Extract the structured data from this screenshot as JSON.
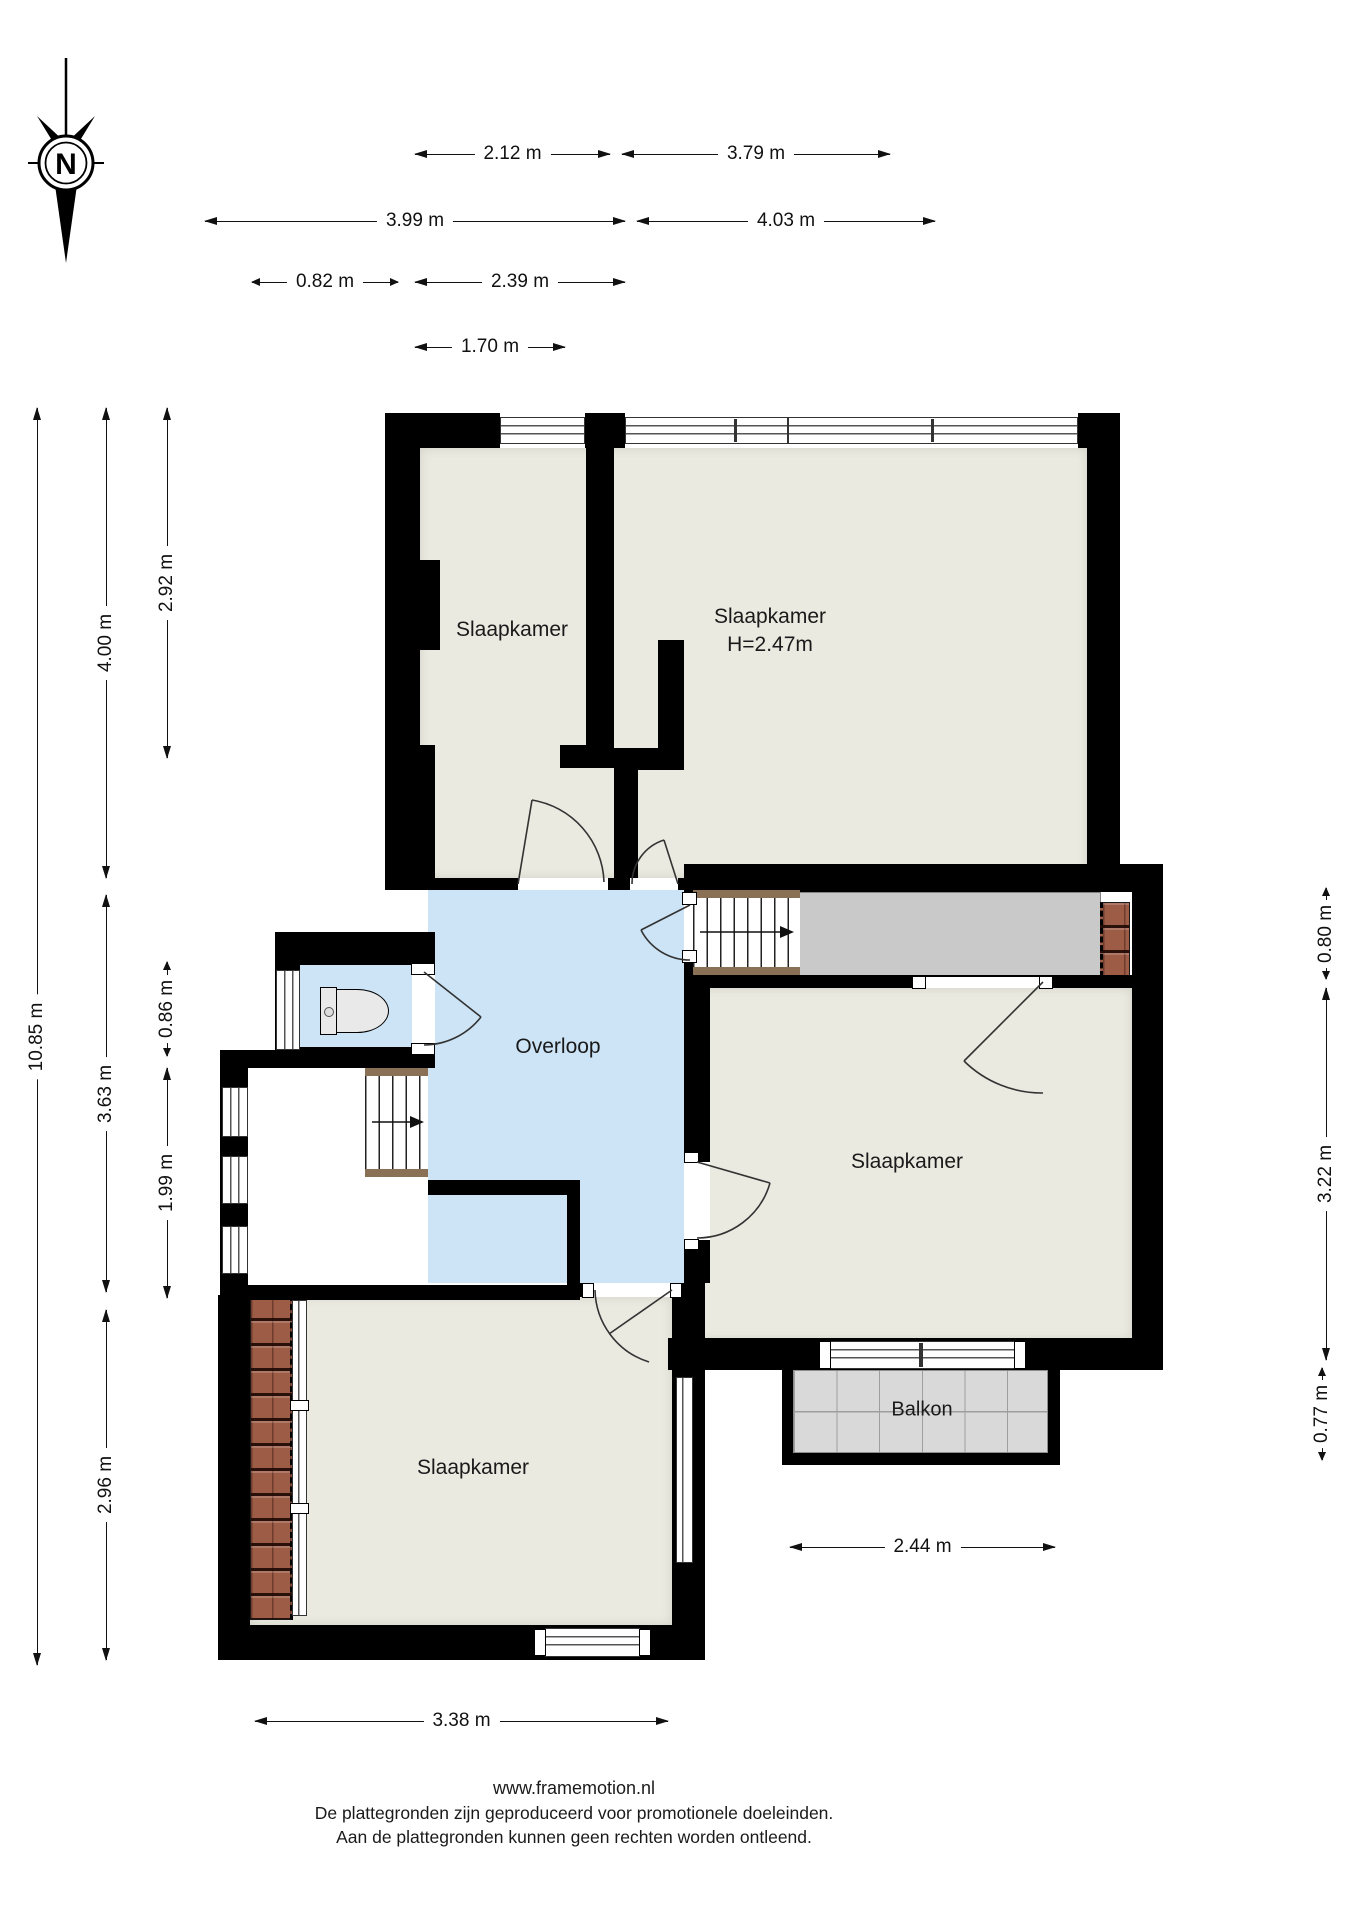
{
  "compass": {
    "label": "N"
  },
  "rooms": {
    "bedroom_top_left": {
      "label": "Slaapkamer"
    },
    "bedroom_top_right": {
      "label": "Slaapkamer",
      "height_note": "H=2.47m"
    },
    "bedroom_right": {
      "label": "Slaapkamer"
    },
    "bedroom_bottom_left": {
      "label": "Slaapkamer"
    },
    "overloop": {
      "label": "Overloop"
    },
    "balkon": {
      "label": "Balkon"
    }
  },
  "dimensions": {
    "top": {
      "d1": "2.12 m",
      "d2": "3.79 m",
      "d3": "3.99 m",
      "d4": "4.03 m",
      "d5": "0.82 m",
      "d6": "2.39 m",
      "d7": "1.70 m"
    },
    "left": {
      "d1": "10.85 m",
      "d2": "4.00 m",
      "d3": "3.63 m",
      "d4": "2.96 m",
      "d5": "2.92 m",
      "d6": "0.86 m",
      "d7": "1.99 m"
    },
    "right": {
      "d1": "0.80 m",
      "d2": "3.22 m",
      "d3": "0.77 m"
    },
    "bottom": {
      "d1": "2.44 m",
      "d2": "3.38 m"
    }
  },
  "footer": {
    "line1": "www.framemotion.nl",
    "line2": "De plattegronden zijn geproduceerd voor promotionele doeleinden.",
    "line3": "Aan de plattegronden kunnen geen rechten worden ontleend."
  },
  "colors": {
    "wall": "#000000",
    "floor": "#eaeae1",
    "hall_blue": "#cce4f6",
    "gray_area": "#c9c9c9",
    "balcony_tile": "#d9d9d9",
    "roof_tile": "#9d5c46",
    "stair_edge": "#8a7156",
    "dimension_text": "#111111"
  }
}
